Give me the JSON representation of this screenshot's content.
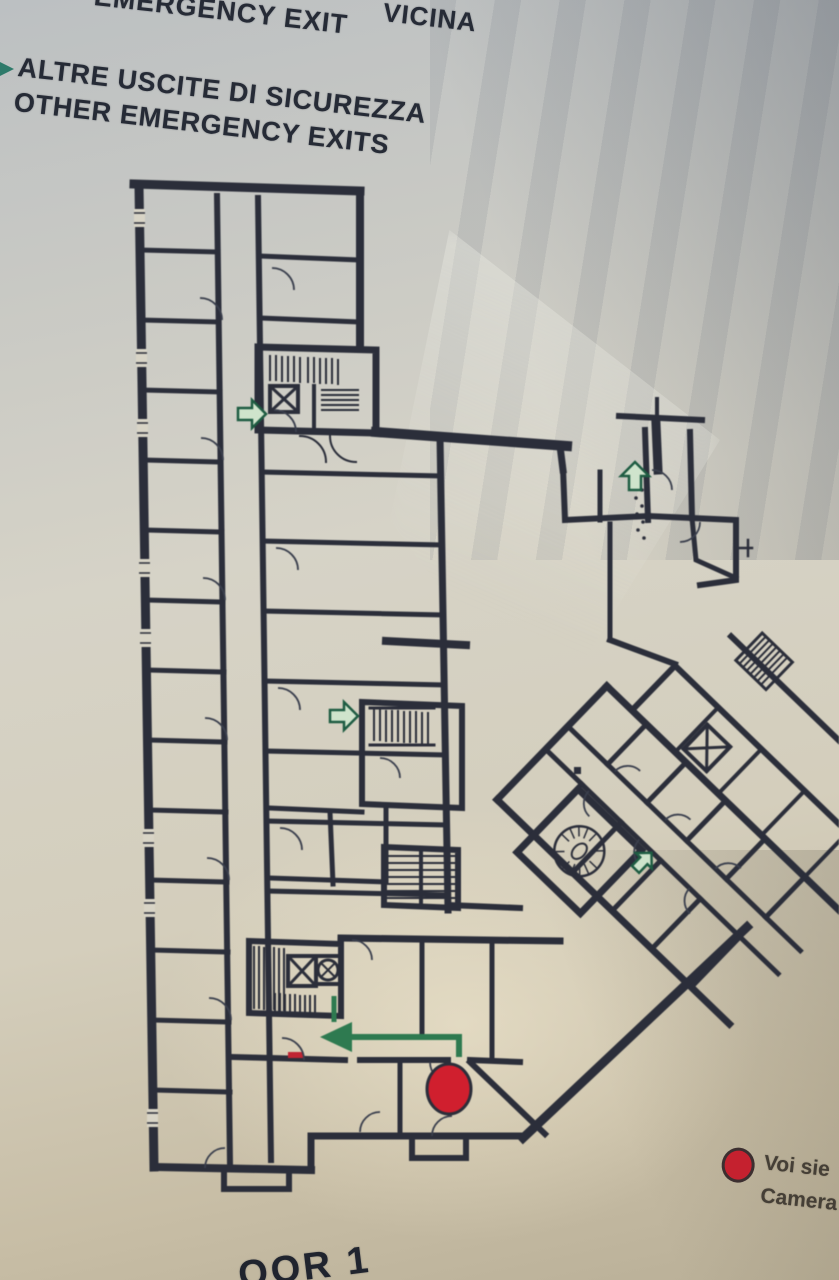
{
  "sign": {
    "nearest_exit_it_fragment": "VICINA",
    "nearest_exit_en": "EMERGENCY EXIT",
    "other_exits_it": "ALTRE USCITE DI SICUREZZA",
    "other_exits_en": "OTHER EMERGENCY EXITS",
    "floor_label_fragment": "OOR 1",
    "legend": {
      "you_are_here_line1": "Voi sie",
      "you_are_here_line2": "Camera"
    }
  },
  "colors": {
    "wall": "#2b2e3a",
    "route_green": "#2e7a50",
    "arrow_green_fill": "#cfe4cc",
    "marker_red": "#d01f2e",
    "legend_red": "#c5212f",
    "paper": "#d8d4c6"
  },
  "icons": {
    "exit_arrow": "exit-arrow-icon",
    "stairs": "stairs-icon",
    "elevator": "elevator-icon",
    "spiral_staircase": "spiral-staircase-icon",
    "you_are_here": "you-are-here-marker"
  }
}
